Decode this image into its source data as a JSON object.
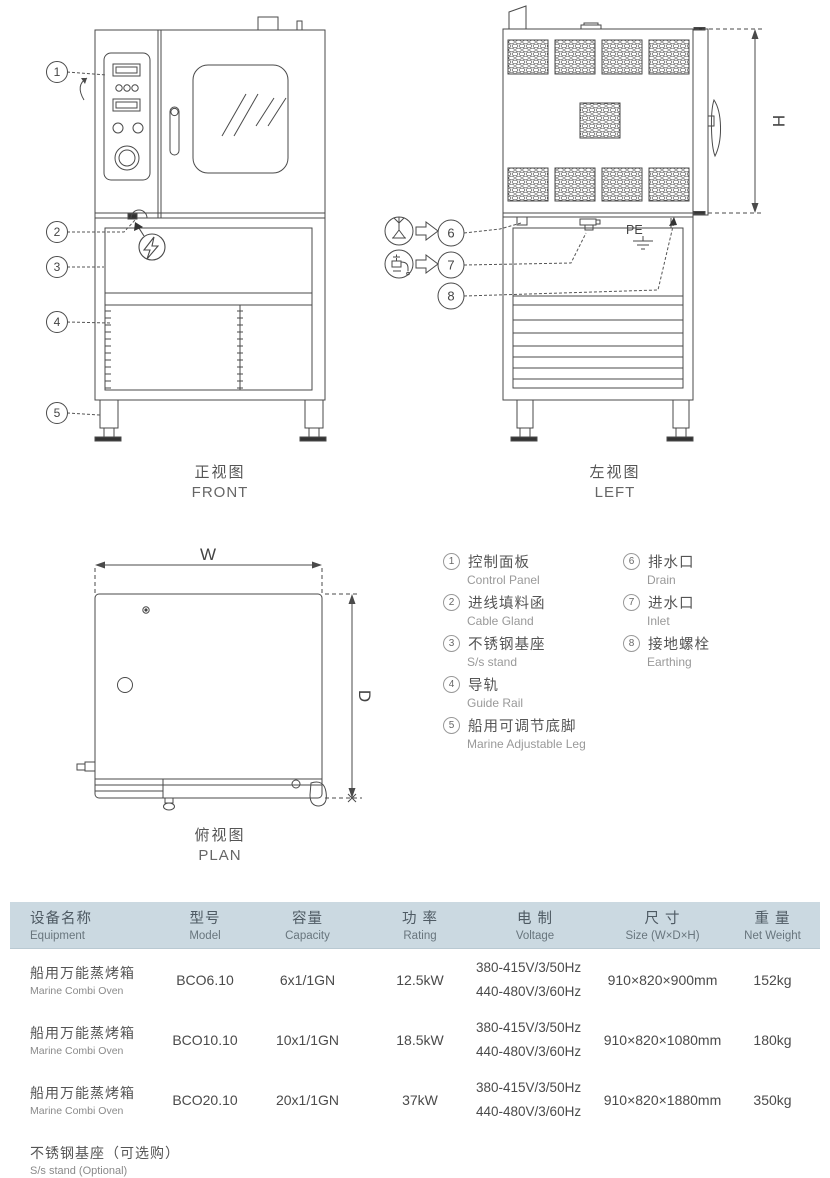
{
  "colors": {
    "line": "#4a4a4a",
    "text": "#555555",
    "subtext": "#979797",
    "table_header_bg": "#cbd9e1"
  },
  "views": {
    "front": {
      "label_zh": "正视图",
      "label_en": "FRONT"
    },
    "left": {
      "label_zh": "左视图",
      "label_en": "LEFT",
      "dim_h": "H",
      "earthing_label": "PE"
    },
    "plan": {
      "label_zh": "俯视图",
      "label_en": "PLAN",
      "dim_w": "W",
      "dim_d": "D"
    }
  },
  "icons": {
    "electric": "lightning-bolt",
    "drain": "floor-drain-symbol",
    "inlet": "water-tap-symbol"
  },
  "legend": {
    "items": [
      {
        "num": "1",
        "zh": "控制面板",
        "en": "Control Panel"
      },
      {
        "num": "2",
        "zh": "进线填料函",
        "en": "Cable Gland"
      },
      {
        "num": "3",
        "zh": "不锈钢基座",
        "en": "S/s stand"
      },
      {
        "num": "4",
        "zh": "导轨",
        "en": "Guide Rail"
      },
      {
        "num": "5",
        "zh": "船用可调节底脚",
        "en": "Marine Adjustable Leg"
      },
      {
        "num": "6",
        "zh": "排水口",
        "en": "Drain"
      },
      {
        "num": "7",
        "zh": "进水口",
        "en": "Inlet"
      },
      {
        "num": "8",
        "zh": "接地螺栓",
        "en": "Earthing"
      }
    ]
  },
  "table": {
    "headers": [
      {
        "zh": "设备名称",
        "en": "Equipment"
      },
      {
        "zh": "型号",
        "en": "Model"
      },
      {
        "zh": "容量",
        "en": "Capacity"
      },
      {
        "zh": "功 率",
        "en": "Rating"
      },
      {
        "zh": "电 制",
        "en": "Voltage"
      },
      {
        "zh": "尺 寸",
        "en": "Size (W×D×H)"
      },
      {
        "zh": "重 量",
        "en": "Net Weight"
      }
    ],
    "rows": [
      {
        "equipment_zh": "船用万能蒸烤箱",
        "equipment_en": "Marine Combi Oven",
        "model": "BCO6.10",
        "capacity": "6x1/1GN",
        "rating": "12.5kW",
        "voltage_line1": "380-415V/3/50Hz",
        "voltage_line2": "440-480V/3/60Hz",
        "size": "910×820×900mm",
        "weight": "152kg"
      },
      {
        "equipment_zh": "船用万能蒸烤箱",
        "equipment_en": "Marine Combi Oven",
        "model": "BCO10.10",
        "capacity": "10x1/1GN",
        "rating": "18.5kW",
        "voltage_line1": "380-415V/3/50Hz",
        "voltage_line2": "440-480V/3/60Hz",
        "size": "910×820×1080mm",
        "weight": "180kg"
      },
      {
        "equipment_zh": "船用万能蒸烤箱",
        "equipment_en": "Marine Combi Oven",
        "model": "BCO20.10",
        "capacity": "20x1/1GN",
        "rating": "37kW",
        "voltage_line1": "380-415V/3/50Hz",
        "voltage_line2": "440-480V/3/60Hz",
        "size": "910×820×1880mm",
        "weight": "350kg"
      }
    ],
    "footnote_zh": "不锈钢基座（可选购）",
    "footnote_en": "S/s stand  (Optional)"
  }
}
